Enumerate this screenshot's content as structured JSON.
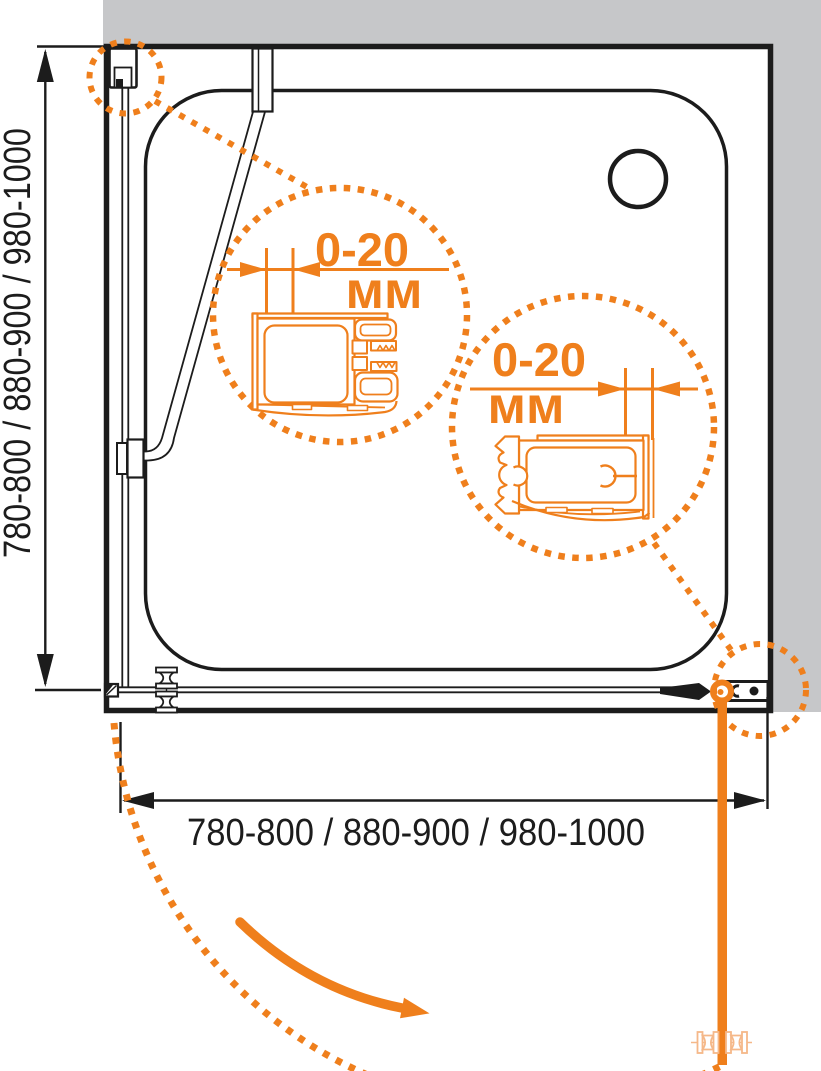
{
  "diagram": {
    "name": "Shower enclosure installation drawing (plan view)",
    "dimension_width_label": "780-800 / 880-900 / 980-1000",
    "dimension_height_label": "780-800 / 880-900 / 980-1000",
    "callout_left": {
      "value": "0-20",
      "unit": "мм"
    },
    "callout_right": {
      "value": "0-20",
      "unit": "мм"
    },
    "colors": {
      "accent_orange": "#EF7F1C",
      "accent_orange_light": "#F5B889",
      "wall_gray": "#C6C7C9",
      "line_black": "#1C1C1C"
    }
  }
}
